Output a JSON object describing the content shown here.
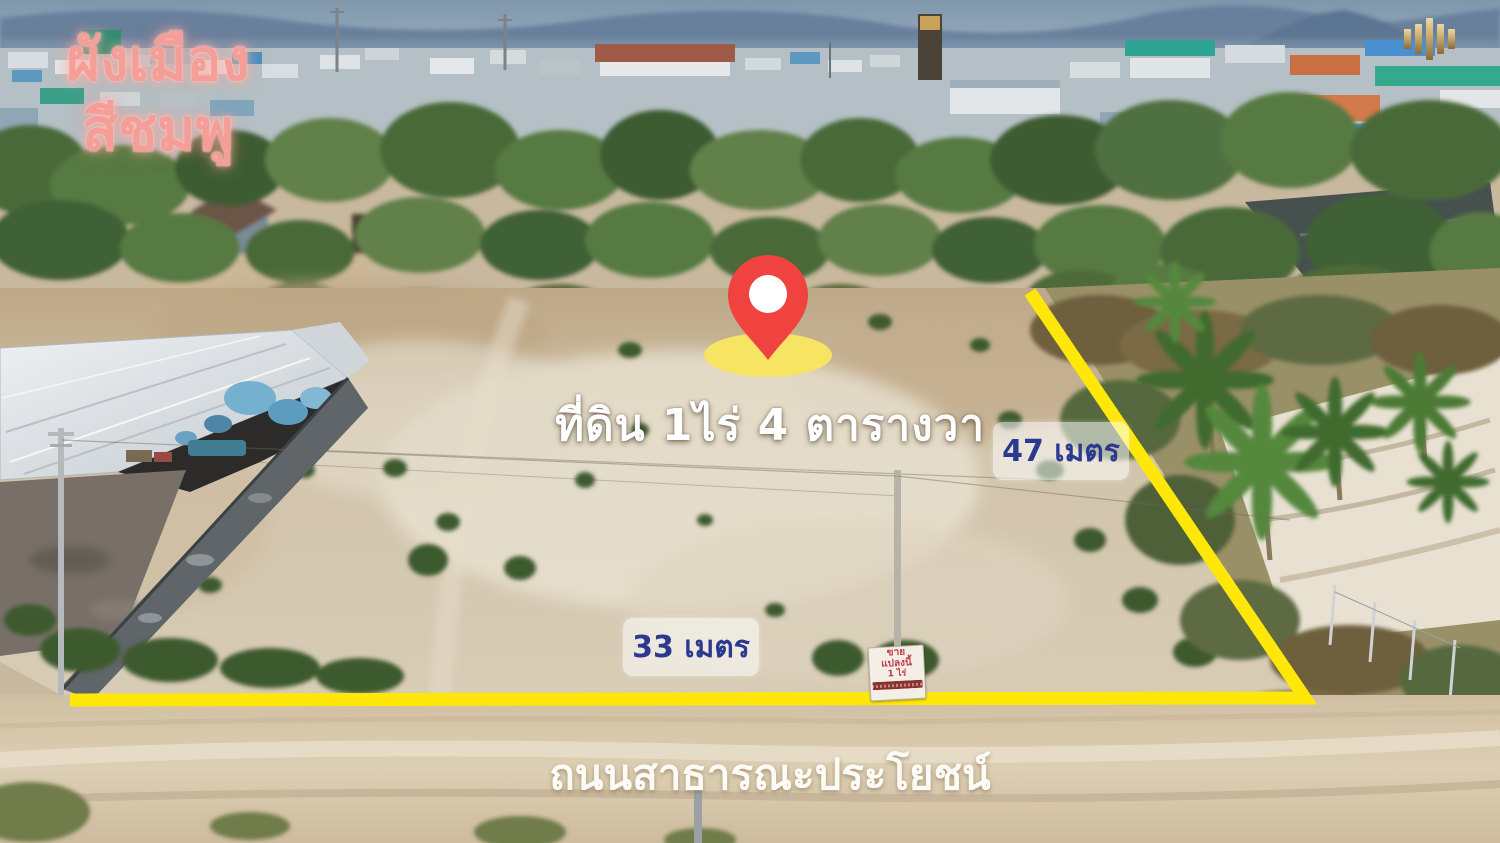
{
  "photo_type": "drone aerial photo of vacant land plot for sale",
  "annotations": {
    "zoning": {
      "line1": "ผังเมือง",
      "line2": "สีชมพู"
    },
    "plot_area_label": "ที่ดิน 1ไร่ 4 ตารางวา",
    "side_length_label": "47 เมตร",
    "frontage_length_label": "33 เมตร",
    "road_label": "ถนนสาธารณะประโยชน์"
  },
  "sale_sign": {
    "lines": [
      "ขาย",
      "แปลงนี้",
      "1 ไร่"
    ]
  },
  "colors": {
    "boundary": "#ffe70a",
    "pin": "#f0433f",
    "pin_halo": "#f7e463",
    "zoning_pink": "#f59d97",
    "measurement_text": "#2b3990",
    "logo_gold": "#c9a96a"
  }
}
